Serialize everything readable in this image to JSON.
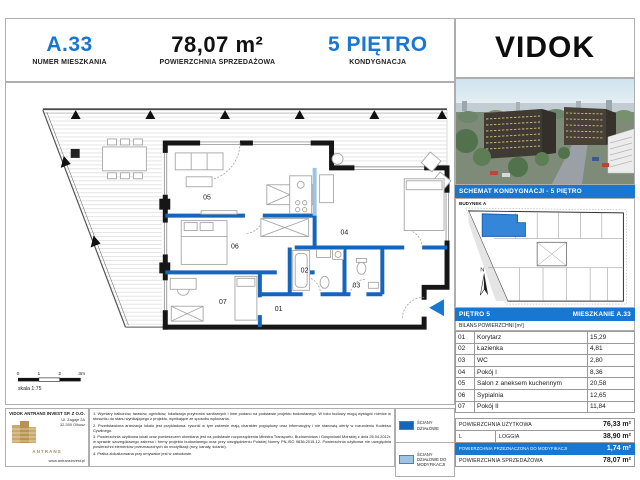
{
  "colors": {
    "accent": "#1877d1",
    "wall_partition": "#1565bd",
    "wall_partition_light": "#9cc4e4",
    "wall_structural": "#161616"
  },
  "header": {
    "unit_number": "A.33",
    "unit_number_label": "NUMER MIESZKANIA",
    "area": "78,07 m²",
    "area_label": "POWIERZCHNIA SPRZEDAŻOWA",
    "floor": "5 PIĘTRO",
    "floor_label": "KONDYGNACJA",
    "brand": "VIDOK"
  },
  "plan": {
    "room_labels": {
      "r01": "01",
      "r02": "02",
      "r03": "03",
      "r04": "04",
      "r05": "05",
      "r06": "06",
      "r07": "07"
    },
    "scale": {
      "label": "skala 1:75",
      "t0": "0",
      "t1": "1",
      "t2": "2",
      "t3": "3m"
    }
  },
  "sidebar": {
    "schemat_bar": "SCHEMAT KONDYGNACJI - 5 PIĘTRO",
    "building_label": "BUDYNEK A",
    "floor_bar_left": "PIĘTRO 5",
    "floor_bar_right": "MIESZKANIE A.33",
    "bilans_title": "BILANS POWIERZCHNI [m²]",
    "rooms": [
      {
        "no": "01",
        "name": "Korytarz",
        "area": "15,29"
      },
      {
        "no": "02",
        "name": "Łazienka",
        "area": "4,81"
      },
      {
        "no": "03",
        "name": "WC",
        "area": "2,80"
      },
      {
        "no": "04",
        "name": "Pokój I",
        "area": "8,36"
      },
      {
        "no": "05",
        "name": "Salon z aneksem kuchennym",
        "area": "20,58"
      },
      {
        "no": "06",
        "name": "Sypialnia",
        "area": "12,65"
      },
      {
        "no": "07",
        "name": "Pokój II",
        "area": "11,84"
      }
    ]
  },
  "totals": {
    "rows": [
      {
        "label": "POWIERZCHNIA UŻYTKOWA",
        "value": "76,33 m²",
        "highlight": false
      },
      {
        "prefix": "L",
        "label": "LOGGIA",
        "value": "38,90 m²",
        "highlight": false
      },
      {
        "label": "POWIERZCHNIA PRZEZNACZONA DO MODYFIKACJI",
        "value": "1,74 m²",
        "highlight": true
      },
      {
        "label": "POWIERZCHNIA SPRZEDAŻOWA",
        "value": "78,07 m²",
        "highlight": false
      }
    ]
  },
  "legend": {
    "items": [
      {
        "label": "ŚCIANY DZIAŁOWE",
        "color": "#1565bd"
      },
      {
        "label": "ŚCIANY DZIAŁOWE DO MODYFIKACJI",
        "color": "#9cc4e4"
      }
    ]
  },
  "company": {
    "name": "VIDOK ANTRANS INVEST SP. Z O.O.",
    "address_line1": "Ul. Zagaje 2A",
    "address_line2": "32-300 Olkusz",
    "website": "www.antransinvest.pl",
    "logo_text": "ANTRANS"
  },
  "notes": {
    "items": [
      "1. Wymiary balkonów, tarasów, ogródków, lokalizacja przyborów sanitarnych i inne podano na podstawie projektu budowlanego. W toku budowy mogą wystąpić różnice w stosunku do stanu wynikającego z projektu, wynikające ze sposobu wykonania.",
      "2. Przedstawiona aranżacja lokalu jest przykładowa, rysunki w tym zakresie mają charakter poglądowy oraz informacyjny i nie stanowią oferty w rozumieniu Kodeksu Cywilnego.",
      "3. Powierzchnia użytkowa lokali oraz pomieszczeń określana jest na podstawie rozporządzenia Ministra Transportu, Budownictwa i Gospodarki Morskiej z dnia 25.04.2012r. w sprawie szczegółowego zakresu i formy projektu budowlanego oraz przy uwzględnieniu Polskiej Normy PN-ISO 9836:2015-12. Powierzchnia użytkowa nie uwzględnia powierzchni elementów przeznaczonych do modyfikacji (rury, kanały, ścianki).",
      "4. Pralka zlokalizowana przy umywalce jest w zabudowie."
    ]
  }
}
